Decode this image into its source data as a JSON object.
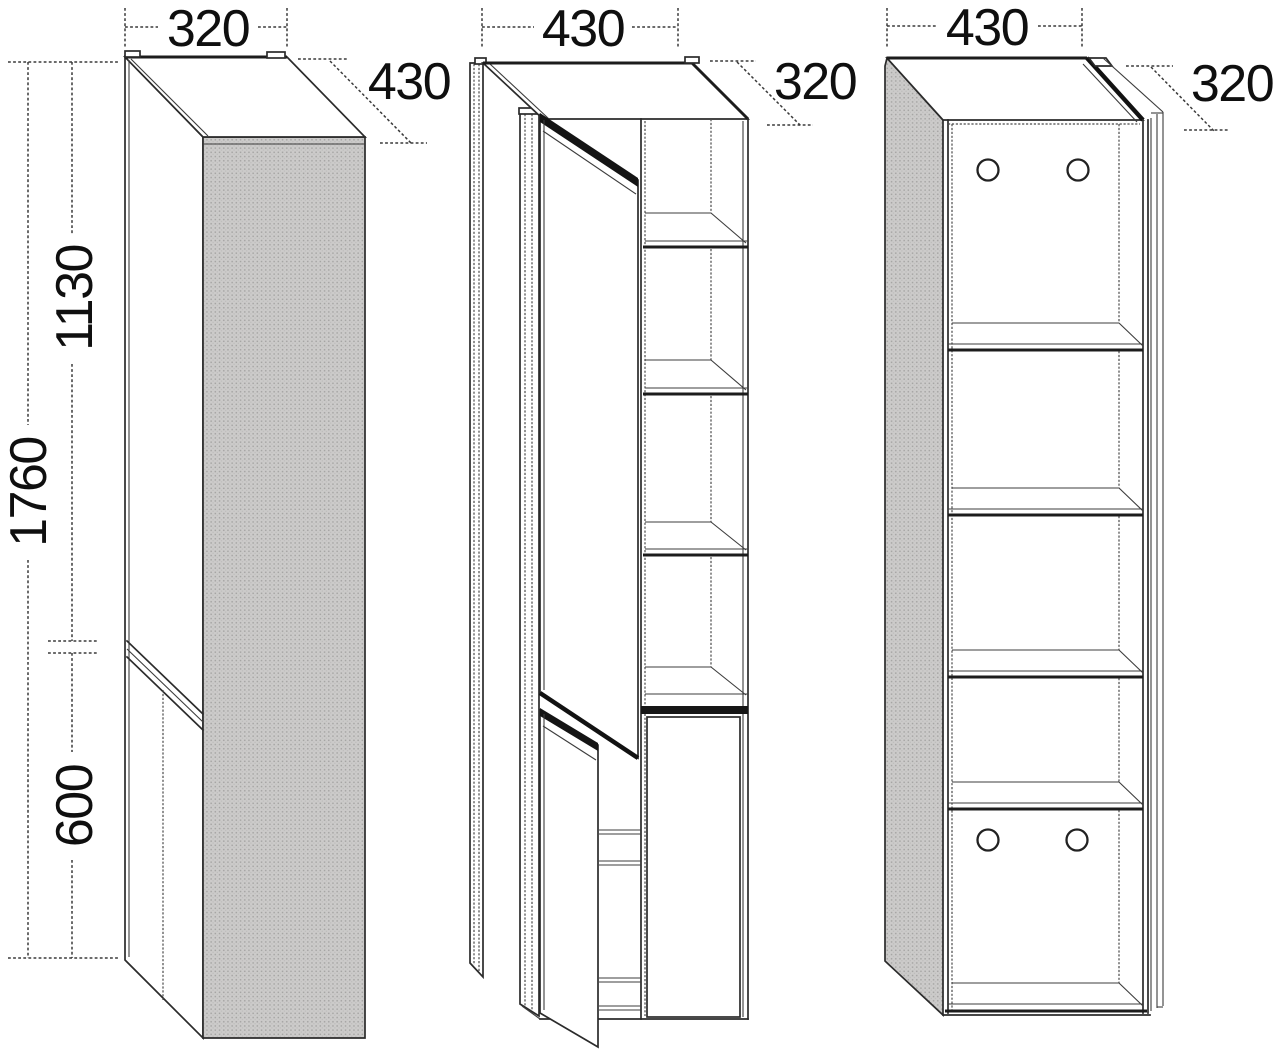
{
  "drawing": {
    "kind": "furniture-technical-drawing",
    "background": "#ffffff",
    "line_color": "#2b2b2b",
    "panel_fill": "#cbcac9",
    "views": {
      "closed": {
        "name": "tall cabinet, closed, perspective"
      },
      "open": {
        "name": "tall cabinet, doors open, perspective"
      },
      "shelf": {
        "name": "tall cabinet, open carcass front view"
      }
    }
  },
  "dims": {
    "closed": {
      "width": "320",
      "depth": "430",
      "height_total": "1760",
      "height_upper_door": "1130",
      "height_lower_door": "600"
    },
    "open": {
      "width": "430",
      "depth": "320"
    },
    "shelf": {
      "width": "430",
      "depth": "320"
    }
  }
}
